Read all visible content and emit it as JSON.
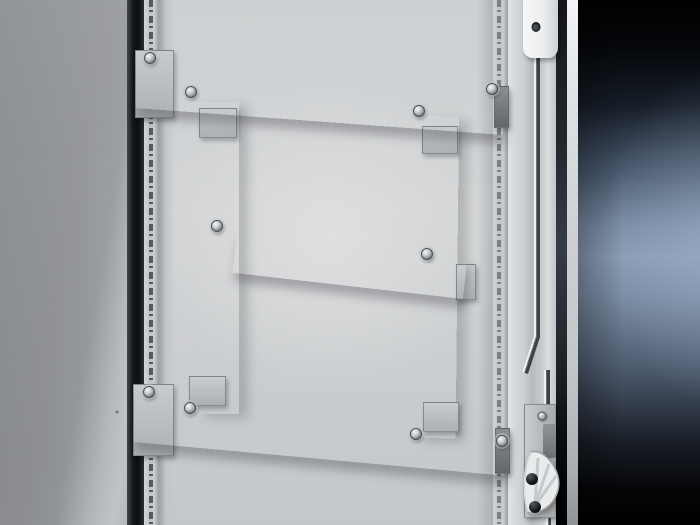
{
  "meta": {
    "type": "product-photograph",
    "subject": "Sheet-steel enclosure door interior with bolted punched mounting rails (H-shaped arrangement) and door locking rod with cam guide",
    "visible_text": ""
  },
  "colors": {
    "panelLeft": "#96989c",
    "panelLeftDark": "#8b8e92",
    "panelEdgeLight": "#cfd2d4",
    "gapDark": "#0c0e10",
    "frameStrip": "#c2c5c7",
    "frameSlot": "#44484c",
    "doorFace": "#d2d4d6",
    "doorHighlight": "#dedfe0",
    "doorShade": "#c5c8ca",
    "railFace1": "#c6c9cb",
    "railFace2": "#a5a8ab",
    "railFlange": "#d8dadb",
    "railHole": "#54575b",
    "railHoleV": "#43464a",
    "vRailFace1": "#b2b5b8",
    "vRailFace2": "#9a9da0",
    "screwSilver": "#f4f5f6",
    "screwBlack": "#17191b",
    "rodDark": "#3f4347",
    "rodHighlight": "#eff0f1",
    "edgeFlange": "#ccd0d2",
    "edgeChannel": "#000000",
    "edgeOuter": "#e2e4e6",
    "lockWhite": "#edeff0",
    "bgTop": "#000000",
    "bgMid": "#8a9cb4",
    "bgBottom": "#000000"
  },
  "scene": {
    "rails": [
      {
        "id": "rail-top",
        "orient": "h",
        "x": 137,
        "y": 62,
        "len": 370,
        "th": 46,
        "tilt": 4.2,
        "z": 14,
        "cells": 12,
        "ps": 30,
        "pe": 12
      },
      {
        "id": "rail-middle",
        "orient": "h",
        "x": 237,
        "y": 232,
        "len": 232,
        "th": 41,
        "tilt": 6.5,
        "z": 14,
        "cells": 7,
        "ps": 40,
        "pe": 14
      },
      {
        "id": "rail-bottom",
        "orient": "h",
        "x": 136,
        "y": 396,
        "len": 374,
        "th": 46,
        "tilt": 5.2,
        "z": 14,
        "cells": 12,
        "ps": 34,
        "pe": 14
      },
      {
        "id": "rail-vertical-left",
        "orient": "v",
        "x": 196,
        "y": 102,
        "len": 312,
        "th": 43,
        "tilt": 0,
        "z": 12,
        "cells": 10,
        "ps": 26,
        "pe": 26
      },
      {
        "id": "rail-vertical-right",
        "orient": "v",
        "x": 419,
        "y": 116,
        "len": 322,
        "th": 40,
        "tilt": 0.6,
        "z": 12,
        "cells": 10,
        "ps": 28,
        "pe": 30
      }
    ],
    "brackets": [
      {
        "id": "bracket-top-left",
        "x": 135,
        "y": 50,
        "w": 37,
        "h": 66,
        "z": 11,
        "dark": false
      },
      {
        "id": "bracket-bottom-left",
        "x": 133,
        "y": 384,
        "w": 39,
        "h": 70,
        "z": 11,
        "dark": false
      },
      {
        "id": "tab-vleft-top",
        "x": 199,
        "y": 108,
        "w": 36,
        "h": 28,
        "z": 13,
        "dark": false
      },
      {
        "id": "tab-vleft-foot",
        "x": 189,
        "y": 376,
        "w": 35,
        "h": 28,
        "z": 13,
        "dark": false
      },
      {
        "id": "tab-vright-top",
        "x": 422,
        "y": 126,
        "w": 34,
        "h": 26,
        "z": 13,
        "dark": false
      },
      {
        "id": "tab-vright-foot",
        "x": 423,
        "y": 402,
        "w": 34,
        "h": 28,
        "z": 13,
        "dark": false
      },
      {
        "id": "tab-middle-right",
        "x": 456,
        "y": 264,
        "w": 18,
        "h": 34,
        "z": 13,
        "dark": false
      },
      {
        "id": "cap-top-right",
        "x": 494,
        "y": 86,
        "w": 13,
        "h": 40,
        "z": 15,
        "dark": true
      },
      {
        "id": "cap-bottom-right",
        "x": 495,
        "y": 428,
        "w": 13,
        "h": 44,
        "z": 15,
        "dark": true
      }
    ],
    "screws": [
      {
        "x": 150,
        "y": 58,
        "t": "silver"
      },
      {
        "x": 191,
        "y": 92,
        "t": "silver"
      },
      {
        "x": 419,
        "y": 111,
        "t": "silver"
      },
      {
        "x": 492,
        "y": 89,
        "t": "silver"
      },
      {
        "x": 217,
        "y": 226,
        "t": "silver"
      },
      {
        "x": 427,
        "y": 254,
        "t": "silver"
      },
      {
        "x": 149,
        "y": 392,
        "t": "silver"
      },
      {
        "x": 190,
        "y": 408,
        "t": "silver"
      },
      {
        "x": 416,
        "y": 434,
        "t": "silver"
      },
      {
        "x": 502,
        "y": 441,
        "t": "silver"
      },
      {
        "x": 542,
        "y": 416,
        "t": "silver-small"
      },
      {
        "x": 532,
        "y": 479,
        "t": "black"
      },
      {
        "x": 535,
        "y": 507,
        "t": "black"
      },
      {
        "x": 536,
        "y": 27,
        "t": "hole"
      },
      {
        "x": 117,
        "y": 412,
        "t": "dot"
      }
    ]
  }
}
